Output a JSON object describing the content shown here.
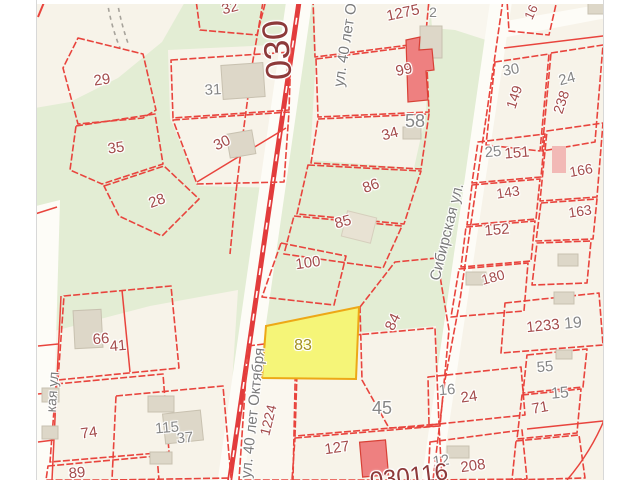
{
  "colors": {
    "maroon": "#a34b4b",
    "gray": "#868686",
    "street": "#7b7b7b",
    "highlight_label": "#a3901c",
    "quarter": "#8d3a3a",
    "bg": "#f7f3e9",
    "green": "#e3edd4",
    "road": "#e23c3c",
    "parcel_line": "#e8443d",
    "highlight_fill": "#f5f578",
    "highlight_stroke": "#eda816"
  },
  "highlighted_parcel": "83",
  "quarter_labels": [
    {
      "text": "030",
      "x": 277,
      "y": 50,
      "rot": -95,
      "size": 36,
      "color": "quarter"
    },
    {
      "text": "030116",
      "x": 409,
      "y": 477,
      "rot": -7,
      "size": 24,
      "color": "quarter"
    }
  ],
  "streets": [
    {
      "name": "ул. 40 лет Октября",
      "x": 349,
      "y": 22,
      "rot": -81,
      "size": 15
    },
    {
      "name": "ул. 40 лет Октября",
      "x": 253,
      "y": 413,
      "rot": -84,
      "size": 15
    },
    {
      "name": "Сибирская ул.",
      "x": 447,
      "y": 232,
      "rot": -76,
      "size": 15
    },
    {
      "name": "кая ул",
      "x": 52,
      "y": 392,
      "rot": -86,
      "size": 14
    }
  ],
  "parcels": [
    {
      "n": "32",
      "x": 230,
      "y": 8,
      "rot": -15,
      "color": "maroon",
      "size": 15
    },
    {
      "n": "29",
      "x": 102,
      "y": 80,
      "rot": -8,
      "color": "maroon",
      "size": 15
    },
    {
      "n": "31",
      "x": 213,
      "y": 90,
      "rot": -3,
      "color": "gray",
      "size": 15
    },
    {
      "n": "35",
      "x": 116,
      "y": 148,
      "rot": -8,
      "color": "maroon",
      "size": 15
    },
    {
      "n": "30",
      "x": 222,
      "y": 143,
      "rot": -25,
      "color": "maroon",
      "size": 15
    },
    {
      "n": "28",
      "x": 157,
      "y": 201,
      "rot": -20,
      "color": "maroon",
      "size": 15
    },
    {
      "n": "1275",
      "x": 403,
      "y": 13,
      "rot": -12,
      "color": "maroon",
      "size": 15
    },
    {
      "n": "2",
      "x": 433,
      "y": 12,
      "rot": 0,
      "color": "gray",
      "size": 14
    },
    {
      "n": "99",
      "x": 404,
      "y": 70,
      "rot": -12,
      "color": "maroon",
      "size": 15
    },
    {
      "n": "58",
      "x": 415,
      "y": 121,
      "rot": 0,
      "color": "gray",
      "size": 18
    },
    {
      "n": "34",
      "x": 390,
      "y": 134,
      "rot": -15,
      "color": "maroon",
      "size": 15
    },
    {
      "n": "86",
      "x": 371,
      "y": 186,
      "rot": -20,
      "color": "maroon",
      "size": 15
    },
    {
      "n": "85",
      "x": 343,
      "y": 222,
      "rot": -15,
      "color": "maroon",
      "size": 15
    },
    {
      "n": "100",
      "x": 308,
      "y": 263,
      "rot": -8,
      "color": "maroon",
      "size": 15
    },
    {
      "n": "83",
      "x": 303,
      "y": 346,
      "rot": 0,
      "color": "highlight_label",
      "size": 16
    },
    {
      "n": "84",
      "x": 393,
      "y": 322,
      "rot": -65,
      "color": "maroon",
      "size": 15
    },
    {
      "n": "45",
      "x": 382,
      "y": 408,
      "rot": 0,
      "color": "gray",
      "size": 18
    },
    {
      "n": "127",
      "x": 337,
      "y": 448,
      "rot": -8,
      "color": "maroon",
      "size": 15
    },
    {
      "n": "1224",
      "x": 268,
      "y": 420,
      "rot": -76,
      "color": "maroon",
      "size": 14
    },
    {
      "n": "66",
      "x": 101,
      "y": 339,
      "rot": -5,
      "color": "maroon",
      "size": 15
    },
    {
      "n": "41",
      "x": 118,
      "y": 346,
      "rot": -5,
      "color": "maroon",
      "size": 15
    },
    {
      "n": "74",
      "x": 89,
      "y": 433,
      "rot": -8,
      "color": "maroon",
      "size": 15
    },
    {
      "n": "89",
      "x": 77,
      "y": 473,
      "rot": -5,
      "color": "maroon",
      "size": 15
    },
    {
      "n": "115",
      "x": 167,
      "y": 428,
      "rot": -5,
      "color": "gray",
      "size": 15
    },
    {
      "n": "37",
      "x": 185,
      "y": 438,
      "rot": -5,
      "color": "gray",
      "size": 15
    },
    {
      "n": "16",
      "x": 531,
      "y": 12,
      "rot": -65,
      "color": "maroon",
      "size": 13
    },
    {
      "n": "30",
      "x": 511,
      "y": 70,
      "rot": -10,
      "color": "gray",
      "size": 15
    },
    {
      "n": "149",
      "x": 514,
      "y": 97,
      "rot": -72,
      "color": "maroon",
      "size": 14
    },
    {
      "n": "24",
      "x": 567,
      "y": 79,
      "rot": -15,
      "color": "gray",
      "size": 15
    },
    {
      "n": "238",
      "x": 561,
      "y": 102,
      "rot": -72,
      "color": "maroon",
      "size": 14
    },
    {
      "n": "25",
      "x": 493,
      "y": 152,
      "rot": -5,
      "color": "gray",
      "size": 15
    },
    {
      "n": "151",
      "x": 517,
      "y": 153,
      "rot": -5,
      "color": "maroon",
      "size": 15
    },
    {
      "n": "166",
      "x": 581,
      "y": 170,
      "rot": -10,
      "color": "maroon",
      "size": 14
    },
    {
      "n": "143",
      "x": 508,
      "y": 192,
      "rot": -8,
      "color": "maroon",
      "size": 14
    },
    {
      "n": "163",
      "x": 580,
      "y": 211,
      "rot": -8,
      "color": "maroon",
      "size": 14
    },
    {
      "n": "152",
      "x": 497,
      "y": 230,
      "rot": -5,
      "color": "maroon",
      "size": 15
    },
    {
      "n": "180",
      "x": 493,
      "y": 277,
      "rot": -15,
      "color": "maroon",
      "size": 14
    },
    {
      "n": "1233",
      "x": 543,
      "y": 326,
      "rot": -6,
      "color": "maroon",
      "size": 15
    },
    {
      "n": "19",
      "x": 573,
      "y": 324,
      "rot": -5,
      "color": "gray",
      "size": 16
    },
    {
      "n": "55",
      "x": 545,
      "y": 367,
      "rot": -5,
      "color": "gray",
      "size": 15
    },
    {
      "n": "15",
      "x": 560,
      "y": 394,
      "rot": -5,
      "color": "gray",
      "size": 16
    },
    {
      "n": "71",
      "x": 540,
      "y": 408,
      "rot": -10,
      "color": "maroon",
      "size": 15
    },
    {
      "n": "16",
      "x": 447,
      "y": 390,
      "rot": -5,
      "color": "gray",
      "size": 15
    },
    {
      "n": "24",
      "x": 469,
      "y": 397,
      "rot": -8,
      "color": "maroon",
      "size": 15
    },
    {
      "n": "12",
      "x": 441,
      "y": 461,
      "rot": -8,
      "color": "gray",
      "size": 15
    },
    {
      "n": "208",
      "x": 473,
      "y": 466,
      "rot": -8,
      "color": "maroon",
      "size": 15
    }
  ]
}
